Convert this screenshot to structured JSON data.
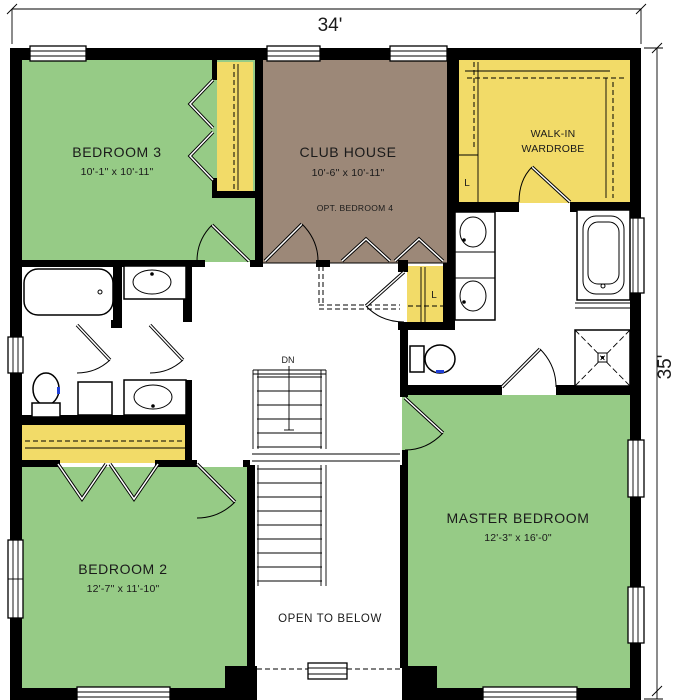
{
  "dimensions": {
    "top": "34'",
    "right": "35'"
  },
  "rooms": {
    "bedroom3": {
      "name": "BEDROOM 3",
      "size": "10'-1\" x 10'-11\""
    },
    "clubhouse": {
      "name": "CLUB HOUSE",
      "size": "10'-6\" x 10'-11\"",
      "note": "OPT. BEDROOM 4"
    },
    "walkin": {
      "line1": "WALK-IN",
      "line2": "WARDROBE"
    },
    "bedroom2": {
      "name": "BEDROOM 2",
      "size": "12'-7\" x 11'-10\""
    },
    "master": {
      "name": "MASTER BEDROOM",
      "size": "12'-3\" x 16'-0\""
    }
  },
  "labels": {
    "open_to_below": "OPEN TO BELOW",
    "down": "DN",
    "linen_upper": "L",
    "linen_lower": "L"
  },
  "colors": {
    "room_green": "#96cb86",
    "room_brown": "#9c8878",
    "closet_yellow": "#f2db68",
    "wall_black": "#000000",
    "accent_blue": "#1f3fd8",
    "background": "#ffffff"
  }
}
